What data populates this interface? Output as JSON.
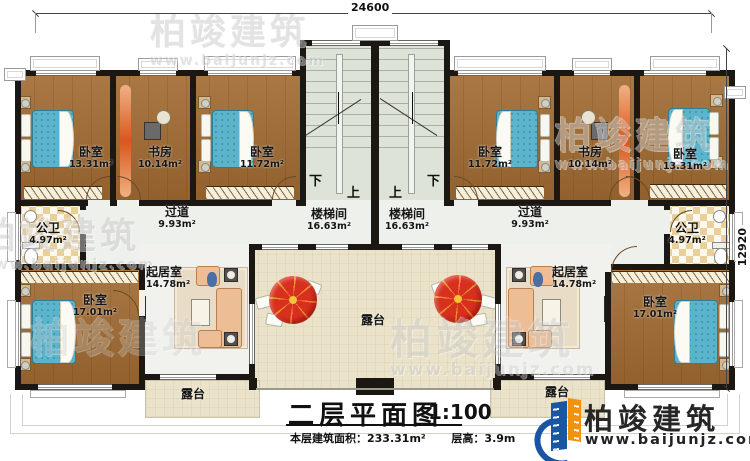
{
  "plan": {
    "dim_top": "24600",
    "dim_right": "12920",
    "rooms": {
      "bedroom_tl": {
        "name": "卧室",
        "area": "13.31m²"
      },
      "study_l": {
        "name": "书房",
        "area": "10.14m²"
      },
      "bedroom_tl2": {
        "name": "卧室",
        "area": "11.72m²"
      },
      "stair_l": {
        "name": "楼梯间",
        "area": "16.63m²"
      },
      "stair_r": {
        "name": "楼梯间",
        "area": "16.63m²"
      },
      "bedroom_tr2": {
        "name": "卧室",
        "area": "11.72m²"
      },
      "study_r": {
        "name": "书房",
        "area": "10.14m²"
      },
      "bedroom_tr": {
        "name": "卧室",
        "area": "13.31m²"
      },
      "hall_l": {
        "name": "过道",
        "area": "9.93m²"
      },
      "hall_r": {
        "name": "过道",
        "area": "9.93m²"
      },
      "bath_l": {
        "name": "公卫",
        "area": "4.97m²"
      },
      "bath_r": {
        "name": "公卫",
        "area": "4.97m²"
      },
      "bedroom_bl": {
        "name": "卧室",
        "area": "17.01m²"
      },
      "bedroom_br": {
        "name": "卧室",
        "area": "17.01m²"
      },
      "living_l": {
        "name": "起居室",
        "area": "14.78m²"
      },
      "living_r": {
        "name": "起居室",
        "area": "14.78m²"
      },
      "terrace_c": {
        "name": "露台"
      },
      "terrace_l": {
        "name": "露台"
      },
      "terrace_r": {
        "name": "露台"
      }
    },
    "stairs": {
      "left": {
        "down": "下",
        "up": "上"
      },
      "right": {
        "up": "上",
        "down": "下"
      }
    }
  },
  "title": {
    "main": "二层平面图",
    "scale": "1:100",
    "area_label": "本层建筑面积：",
    "area_value": "233.31m²",
    "height_label": "层高：",
    "height_value": "3.9m"
  },
  "brand": {
    "name": "柏竣建筑",
    "url": "www.baijunjz.com"
  },
  "watermark": {
    "name": "柏竣建筑",
    "url": "www.baijunjz.com"
  }
}
